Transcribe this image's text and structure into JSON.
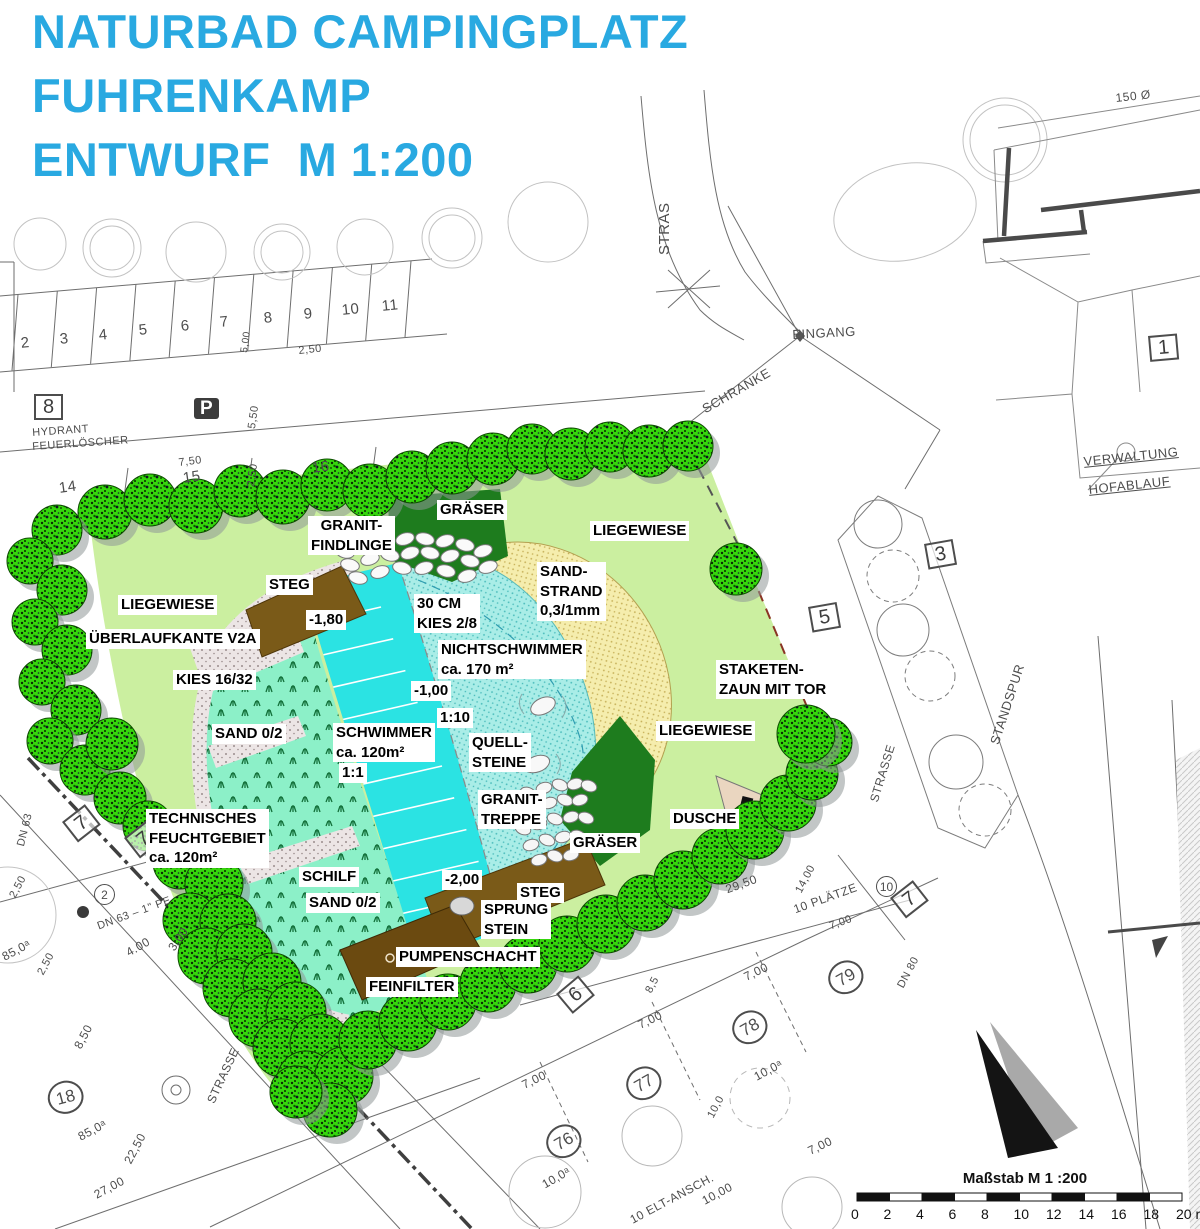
{
  "title": {
    "lines": [
      "NATURBAD CAMPINGPLATZ",
      "FUHRENKAMP",
      "ENTWURF  M 1:200"
    ],
    "color": "#29A9E1"
  },
  "colors": {
    "title_blue": "#29A9E1",
    "lawn_green": "#CBEFA0",
    "swimmer_cyan": "#2BE3E3",
    "shallow_cyan": "#A9EDE7",
    "sand_yellow": "#F5EDAD",
    "wetland_green": "#8CF0C8",
    "wood_brown": "#7A5A18",
    "dark_green": "#1E7C1E",
    "tree_green": "#35D60C",
    "fence_red": "#8A3424"
  },
  "plan_labels": [
    {
      "t": "GRÄSER",
      "x": 437,
      "y": 500
    },
    {
      "t": "GRANIT-\nFINDLINGE",
      "x": 308,
      "y": 516,
      "c": 1
    },
    {
      "t": "LIEGEWIESE",
      "x": 590,
      "y": 521
    },
    {
      "t": "STEG",
      "x": 266,
      "y": 575
    },
    {
      "t": "SAND-\nSTRAND\n0,3/1mm",
      "x": 537,
      "y": 562
    },
    {
      "t": "LIEGEWIESE",
      "x": 118,
      "y": 595
    },
    {
      "t": "-1,80",
      "x": 306,
      "y": 610
    },
    {
      "t": "30 CM\nKIES 2/8",
      "x": 414,
      "y": 594
    },
    {
      "t": "ÜBERLAUFKANTE V2A",
      "x": 86,
      "y": 629
    },
    {
      "t": "NICHTSCHWIMMER\nca. 170 m²",
      "x": 438,
      "y": 640
    },
    {
      "t": "KIES 16/32",
      "x": 173,
      "y": 670
    },
    {
      "t": "-1,00",
      "x": 411,
      "y": 681
    },
    {
      "t": "STAKETEN-\nZAUN MIT TOR",
      "x": 716,
      "y": 660
    },
    {
      "t": "1:10",
      "x": 437,
      "y": 708
    },
    {
      "t": "SAND 0/2",
      "x": 212,
      "y": 724
    },
    {
      "t": "SCHWIMMER\nca. 120m²",
      "x": 333,
      "y": 723
    },
    {
      "t": "QUELL-\nSTEINE",
      "x": 469,
      "y": 733
    },
    {
      "t": "LIEGEWIESE",
      "x": 656,
      "y": 721
    },
    {
      "t": "1:1",
      "x": 339,
      "y": 763
    },
    {
      "t": "GRANIT-\nTREPPE",
      "x": 478,
      "y": 790
    },
    {
      "t": "DUSCHE",
      "x": 670,
      "y": 809
    },
    {
      "t": "TECHNISCHES\nFEUCHTGEBIET\nca. 120m²",
      "x": 146,
      "y": 809
    },
    {
      "t": "GRÄSER",
      "x": 570,
      "y": 833
    },
    {
      "t": "SCHILF",
      "x": 299,
      "y": 867
    },
    {
      "t": "-2,00",
      "x": 442,
      "y": 870
    },
    {
      "t": "SAND 0/2",
      "x": 306,
      "y": 893
    },
    {
      "t": "STEG",
      "x": 517,
      "y": 883
    },
    {
      "t": "SPRUNG\nSTEIN",
      "x": 481,
      "y": 900
    },
    {
      "t": "PUMPENSCHACHT",
      "x": 396,
      "y": 947
    },
    {
      "t": "FEINFILTER",
      "x": 366,
      "y": 977
    }
  ],
  "scan_labels": [
    {
      "t": "STRAS",
      "x": 657,
      "y": 255,
      "r": -90,
      "f": 15
    },
    {
      "t": "EINGANG",
      "x": 792,
      "y": 328,
      "r": -3
    },
    {
      "t": "SCHRANKE",
      "x": 700,
      "y": 404,
      "r": -30
    },
    {
      "t": "150 Ø",
      "x": 1115,
      "y": 92,
      "r": -6,
      "f": 12
    },
    {
      "t": "1",
      "x": 1148,
      "y": 336,
      "r": -5,
      "k": "box"
    },
    {
      "t": "VERWALTUNG",
      "x": 1083,
      "y": 455,
      "r": -6,
      "u": 1
    },
    {
      "t": "HOFABLAUF",
      "x": 1088,
      "y": 483,
      "r": -6,
      "u": 1
    },
    {
      "t": "3",
      "x": 924,
      "y": 544,
      "r": -10,
      "k": "box"
    },
    {
      "t": "5",
      "x": 808,
      "y": 607,
      "r": -10,
      "k": "box"
    },
    {
      "t": "STANDSPUR",
      "x": 988,
      "y": 742,
      "r": -72
    },
    {
      "t": "STRASSE",
      "x": 868,
      "y": 800,
      "r": -73,
      "f": 12
    },
    {
      "t": "STRASSE",
      "x": 205,
      "y": 1100,
      "r": -65,
      "f": 12
    },
    {
      "t": "2",
      "x": 20,
      "y": 336,
      "r": -6,
      "f": 15
    },
    {
      "t": "3",
      "x": 59,
      "y": 332,
      "r": -6,
      "f": 15
    },
    {
      "t": "4",
      "x": 98,
      "y": 328,
      "r": -6,
      "f": 15
    },
    {
      "t": "5",
      "x": 138,
      "y": 323,
      "r": -6,
      "f": 15
    },
    {
      "t": "6",
      "x": 180,
      "y": 319,
      "r": -6,
      "f": 15
    },
    {
      "t": "7",
      "x": 219,
      "y": 315,
      "r": -6,
      "f": 15
    },
    {
      "t": "8",
      "x": 263,
      "y": 311,
      "r": -6,
      "f": 15
    },
    {
      "t": "9",
      "x": 303,
      "y": 307,
      "r": -6,
      "f": 15
    },
    {
      "t": "10",
      "x": 341,
      "y": 303,
      "r": -6,
      "f": 15
    },
    {
      "t": "11",
      "x": 381,
      "y": 299,
      "r": -6,
      "f": 15
    },
    {
      "t": "5,00",
      "x": 240,
      "y": 352,
      "r": -82,
      "f": 10
    },
    {
      "t": "2,50",
      "x": 298,
      "y": 346,
      "r": -6,
      "f": 11
    },
    {
      "t": "8",
      "x": 34,
      "y": 394,
      "k": "box"
    },
    {
      "t": "HYDRANT",
      "x": 32,
      "y": 428,
      "r": -4,
      "f": 11
    },
    {
      "t": "FEUERLÖSCHER",
      "x": 32,
      "y": 442,
      "r": -4,
      "f": 11
    },
    {
      "t": "P",
      "x": 194,
      "y": 398,
      "k": "psign"
    },
    {
      "t": "5,50",
      "x": 247,
      "y": 428,
      "r": -82,
      "f": 11
    },
    {
      "t": "7,50",
      "x": 178,
      "y": 458,
      "r": -7,
      "f": 11
    },
    {
      "t": "2,50",
      "x": 246,
      "y": 486,
      "r": -82,
      "f": 11
    },
    {
      "t": "14",
      "x": 58,
      "y": 481,
      "r": -8,
      "f": 15
    },
    {
      "t": "15",
      "x": 182,
      "y": 471,
      "r": -8,
      "f": 15
    },
    {
      "t": "16",
      "x": 311,
      "y": 461,
      "r": -8,
      "f": 15
    },
    {
      "t": "6",
      "x": 556,
      "y": 994,
      "r": -40,
      "k": "box"
    },
    {
      "t": "76",
      "x": 540,
      "y": 1136,
      "r": -30,
      "k": "circ"
    },
    {
      "t": "10,0ᵃ",
      "x": 540,
      "y": 1180,
      "r": -30,
      "f": 12
    },
    {
      "t": "77",
      "x": 620,
      "y": 1078,
      "r": -30,
      "k": "circ"
    },
    {
      "t": "78",
      "x": 726,
      "y": 1022,
      "r": -30,
      "k": "circ"
    },
    {
      "t": "10,0ᵃ",
      "x": 752,
      "y": 1072,
      "r": -28,
      "f": 12
    },
    {
      "t": "79",
      "x": 822,
      "y": 972,
      "r": -30,
      "k": "circ"
    },
    {
      "t": "7,00",
      "x": 636,
      "y": 1020,
      "r": -26,
      "f": 12
    },
    {
      "t": "7,00",
      "x": 742,
      "y": 972,
      "r": -26,
      "f": 12
    },
    {
      "t": "7,00",
      "x": 520,
      "y": 1080,
      "r": -26,
      "f": 12
    },
    {
      "t": "7,00",
      "x": 806,
      "y": 1146,
      "r": -26,
      "f": 12
    },
    {
      "t": "10,00",
      "x": 700,
      "y": 1196,
      "r": -28,
      "f": 12
    },
    {
      "t": "10 ELT-ANSCH.",
      "x": 628,
      "y": 1215,
      "r": -28,
      "f": 12
    },
    {
      "t": "8,5",
      "x": 644,
      "y": 990,
      "r": -62,
      "f": 11
    },
    {
      "t": "10,0",
      "x": 706,
      "y": 1115,
      "r": -62,
      "f": 11
    },
    {
      "t": "29,50",
      "x": 724,
      "y": 884,
      "r": -20,
      "f": 12
    },
    {
      "t": "14,00",
      "x": 794,
      "y": 890,
      "r": -62,
      "f": 11
    },
    {
      "t": "10 PLÄTZE",
      "x": 792,
      "y": 904,
      "r": -20,
      "f": 12
    },
    {
      "t": "7,00",
      "x": 828,
      "y": 922,
      "r": -20,
      "f": 11
    },
    {
      "t": "10",
      "x": 876,
      "y": 876,
      "k": "circ",
      "s": 1
    },
    {
      "t": "7",
      "x": 890,
      "y": 898,
      "r": -38,
      "k": "box"
    },
    {
      "t": "DN 80",
      "x": 896,
      "y": 985,
      "r": -62,
      "f": 11
    },
    {
      "t": "7",
      "x": 62,
      "y": 822,
      "r": -38,
      "k": "box"
    },
    {
      "t": "7",
      "x": 124,
      "y": 838,
      "r": -38,
      "k": "box"
    },
    {
      "t": "DN 63",
      "x": 16,
      "y": 845,
      "r": -76,
      "f": 11
    },
    {
      "t": "2,50",
      "x": 8,
      "y": 895,
      "r": -62,
      "f": 11
    },
    {
      "t": "85,0ᵃ",
      "x": 0,
      "y": 952,
      "r": -28,
      "f": 12
    },
    {
      "t": "2,50",
      "x": 36,
      "y": 972,
      "r": -62,
      "f": 11
    },
    {
      "t": "4.00",
      "x": 124,
      "y": 948,
      "r": -30,
      "f": 12
    },
    {
      "t": "3.00",
      "x": 166,
      "y": 946,
      "r": -55,
      "f": 12
    },
    {
      "t": "DN 63 – 1\" PE",
      "x": 96,
      "y": 922,
      "r": -20,
      "f": 11
    },
    {
      "t": "2",
      "x": 94,
      "y": 884,
      "k": "circ",
      "s": 1
    },
    {
      "t": "18",
      "x": 44,
      "y": 1086,
      "r": -15,
      "k": "circ"
    },
    {
      "t": "85,0ᵃ",
      "x": 76,
      "y": 1132,
      "r": -28,
      "f": 12
    },
    {
      "t": "22,50",
      "x": 122,
      "y": 1160,
      "r": -62,
      "f": 12
    },
    {
      "t": "27,00",
      "x": 92,
      "y": 1190,
      "r": -28,
      "f": 12
    },
    {
      "t": "8,50",
      "x": 72,
      "y": 1045,
      "r": -62,
      "f": 12
    }
  ],
  "scalebar": {
    "caption": "Maßstab M 1 :200",
    "ticks": [
      "0",
      "2",
      "4",
      "6",
      "8",
      "10",
      "12",
      "14",
      "16",
      "18",
      "20 m"
    ]
  }
}
